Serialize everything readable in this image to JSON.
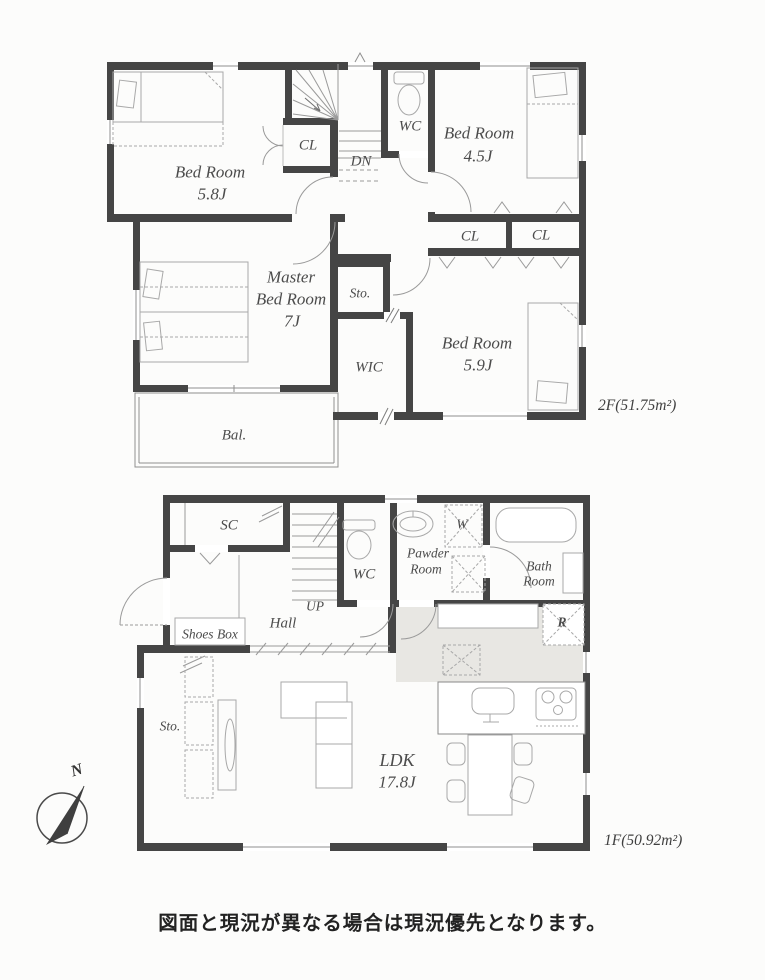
{
  "f2": {
    "area": "2F(51.75m²)",
    "bedroom1_name": "Bed Room",
    "bedroom1_size": "5.8J",
    "cl1": "CL",
    "dn": "DN",
    "wc": "WC",
    "bedroom2_name": "Bed Room",
    "bedroom2_size": "4.5J",
    "cl2": "CL",
    "cl3": "CL",
    "master1": "Master",
    "master2": "Bed Room",
    "master3": "7J",
    "sto": "Sto.",
    "wic": "WIC",
    "bedroom3_name": "Bed Room",
    "bedroom3_size": "5.9J",
    "bal": "Bal."
  },
  "f1": {
    "area": "1F(50.92m²)",
    "sc": "SC",
    "wc": "WC",
    "powder1": "Pawder",
    "powder2": "Room",
    "w": "W",
    "bath1": "Bath",
    "bath2": "Room",
    "up": "UP",
    "hall": "Hall",
    "shoes_box": "Shoes Box",
    "r": "R",
    "sto": "Sto.",
    "ldk_name": "LDK",
    "ldk_size": "17.8J"
  },
  "compass": {
    "n": "N"
  },
  "footer": "図面と現況が異なる場合は現況優先となります。",
  "colors": {
    "wall": "#454545",
    "kitchen_shade": "#e8e7e3",
    "line": "#8f8f8f"
  }
}
